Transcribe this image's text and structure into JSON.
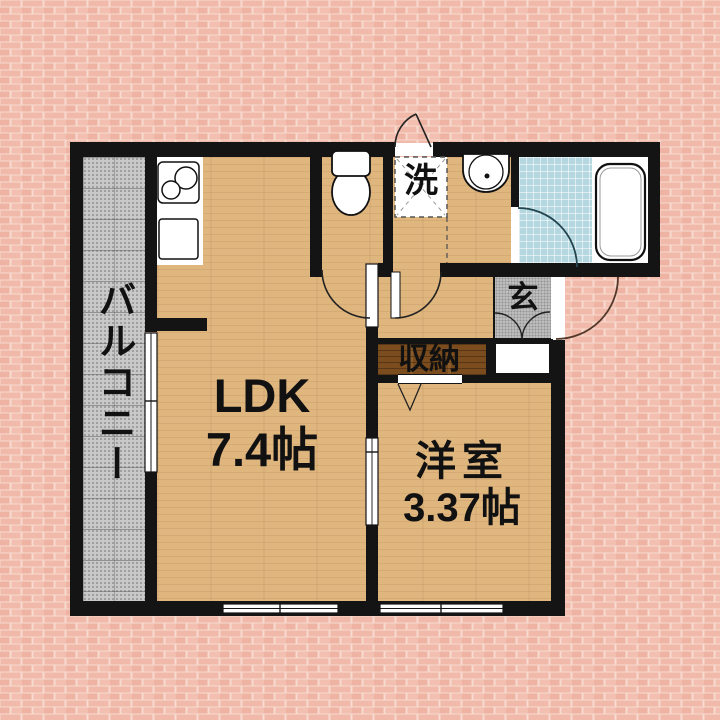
{
  "title": "apartment floor plan",
  "rooms": {
    "balcony": {
      "label": "バルコニー"
    },
    "ldk": {
      "label": "LDK",
      "area": "7.4帖"
    },
    "western_room": {
      "label": "洋室",
      "area": "3.37帖"
    },
    "storage": {
      "label": "収納"
    },
    "entrance": {
      "label": "玄"
    },
    "laundry": {
      "label": "洗"
    }
  },
  "fixtures": [
    "kitchen-stove",
    "kitchen-sink",
    "toilet",
    "washing-machine-space",
    "washbasin",
    "bathtub",
    "shoe-cabinet",
    "sliding-door",
    "window",
    "hinged-door"
  ],
  "colors": {
    "wall": "#141414",
    "wood_floor": "#e0b67f",
    "closet_dark_wood": "#7b4c1e",
    "balcony_gray": "#c9c9c9",
    "entrance_gray": "#c6c6c6",
    "bath_tile_blue": "#b4d7e0",
    "brick_mortar": "#f7dbd0",
    "brick": "#f0b9a9",
    "fixture_white": "#ffffff",
    "front_door_arc": "#53382a"
  }
}
